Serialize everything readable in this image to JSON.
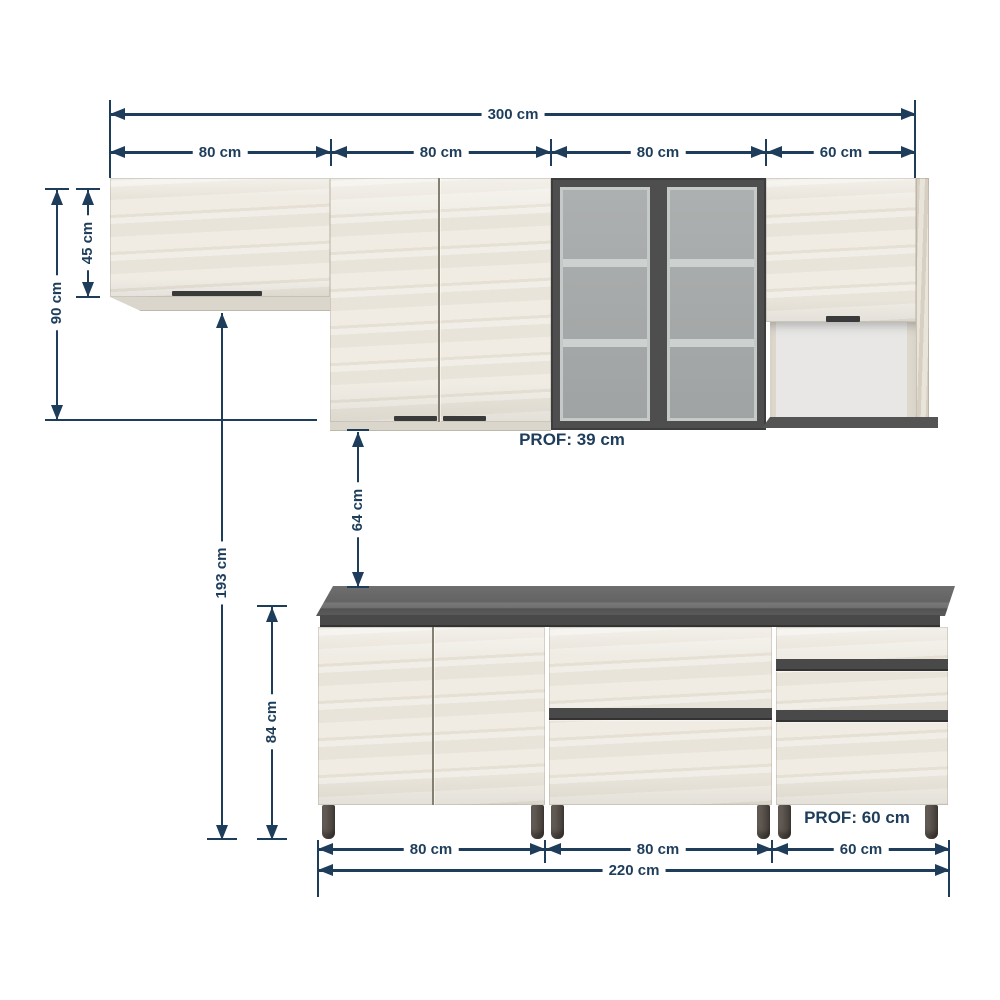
{
  "diagram": {
    "upper_run": {
      "total_width_label": "300 cm",
      "segment_labels": [
        "80 cm",
        "80 cm",
        "80 cm",
        "60 cm"
      ],
      "flap_cabinet_height_label": "45 cm",
      "tall_cabinet_height_label": "90 cm",
      "depth_label": "PROF: 39 cm"
    },
    "middle": {
      "wall_gap_label": "64 cm",
      "total_height_label": "193 cm"
    },
    "base_run": {
      "height_label": "84 cm",
      "segment_labels": [
        "80 cm",
        "80 cm",
        "60 cm"
      ],
      "total_width_label": "220 cm",
      "depth_label": "PROF: 60 cm"
    },
    "colors": {
      "dimension": "#1e3d5b",
      "wood": "#ebe7de",
      "countertop": "#636363",
      "glass_frame": "#4e4e4e",
      "glass": "#a6a9a8",
      "handle": "#3a3a3a"
    }
  }
}
